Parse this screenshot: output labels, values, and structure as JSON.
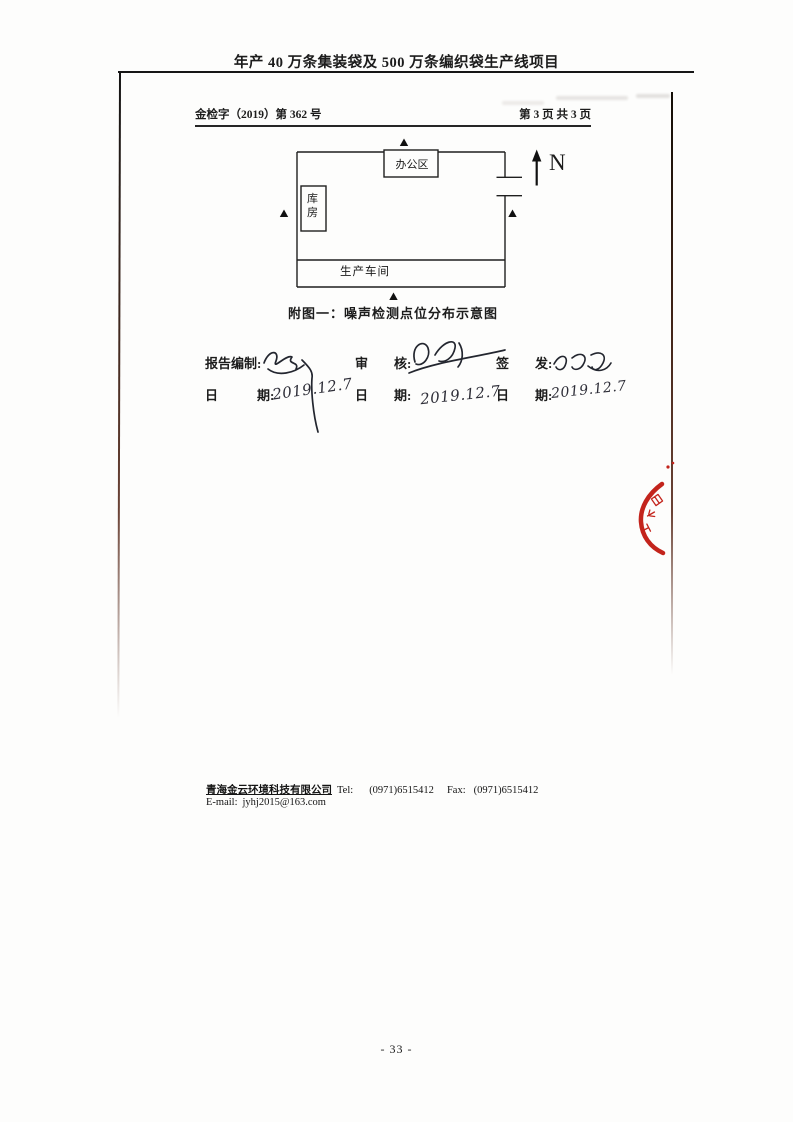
{
  "header": {
    "title": "年产 40 万条集装袋及 500 万条编织袋生产线项目",
    "report_no": "金检字（2019）第 362 号",
    "page_info": "第 3 页 共 3 页"
  },
  "diagram": {
    "office": "办公区",
    "warehouse": "库房",
    "workshop": "生产车间",
    "north": "N",
    "marker": "▲",
    "noise_points": [
      "north-outside-boundary",
      "west-outside-boundary",
      "east-inside-gate",
      "south-outside-boundary"
    ],
    "caption": "附图一：噪声检测点位分布示意图"
  },
  "signoff": {
    "columns": [
      {
        "role": "报告编制:",
        "signature": "handwritten signature (illegible)",
        "date_label": "日　　　期:",
        "date": "2019.12.7"
      },
      {
        "role": "审　　核:",
        "signature": "handwritten signature (illegible)",
        "date_label": "日　　期:",
        "date": "2019.12.7"
      },
      {
        "role": "签　　发:",
        "signature": "handwritten signature (illegible)",
        "date_label": "日　　期:",
        "date": "2019.12.7"
      }
    ]
  },
  "stamp": {
    "description": "partial red circular seal at right page edge, characters illegible",
    "color": "#c3241c"
  },
  "footer": {
    "company": "青海金云环境科技有限公司",
    "tel_label": "Tel:",
    "tel": "(0971)6515412",
    "fax_label": "Fax:",
    "fax": "(0971)6515412",
    "email_label": "E-mail:",
    "email": "jyhj2015@163.com"
  },
  "page_number": "- 33 -"
}
